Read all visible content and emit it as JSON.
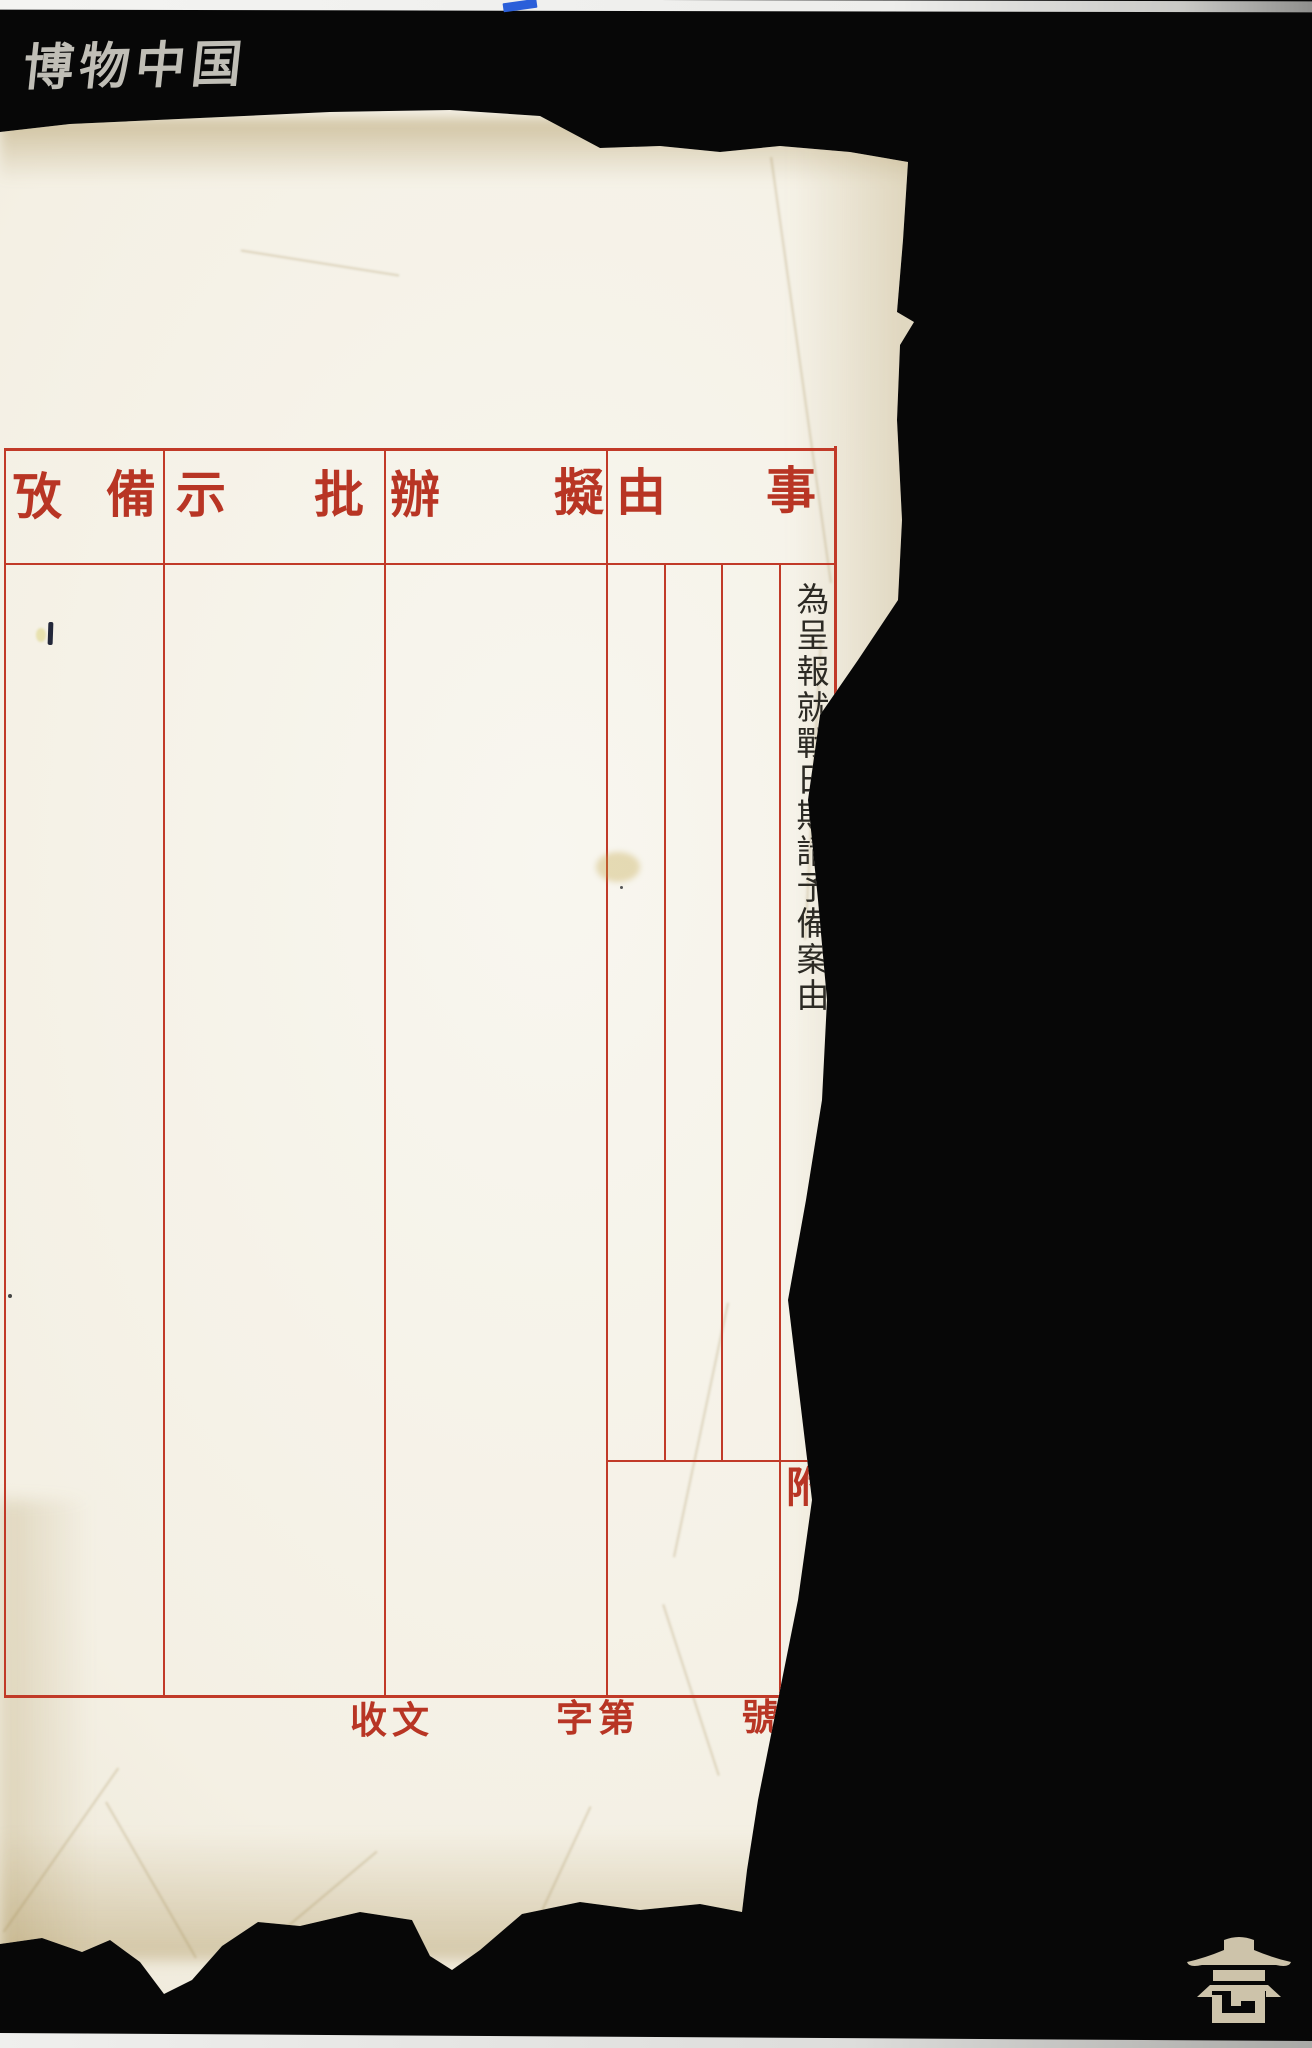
{
  "watermark": {
    "text": "博物中国"
  },
  "form": {
    "columns": [
      {
        "name": "subject",
        "first": "事",
        "second": "由"
      },
      {
        "name": "proposed-handling",
        "first": "擬",
        "second": "辦"
      },
      {
        "name": "instruction",
        "first": "批",
        "second": "示"
      },
      {
        "name": "remarks",
        "first": "備",
        "second": "攷"
      }
    ],
    "subject_entry": {
      "text": "為呈報就戰日期請予備案由"
    },
    "attachment": {
      "top": "附",
      "bottom": "件"
    },
    "footer": {
      "receive": "收文",
      "classifier": "字第",
      "number": "號"
    }
  },
  "colors": {
    "form_red": "#c13a28",
    "ink": "#2c2a24",
    "paper": "#f5f2e8",
    "watermark_white": "#e9e6df",
    "logo_tan": "#cdc3aa",
    "tape_blue": "#2b5fd9",
    "background": "#070707"
  },
  "logo": {
    "icon": "pagoda-icon"
  }
}
